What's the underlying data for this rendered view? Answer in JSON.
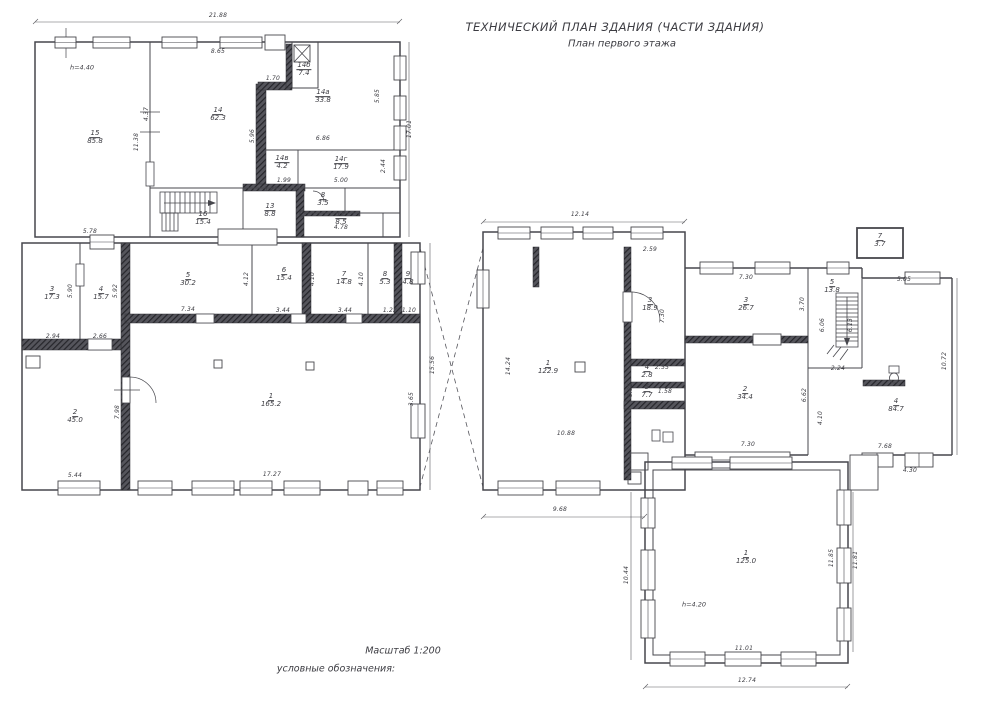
{
  "title": {
    "line1": "ТЕХНИЧЕСКИЙ ПЛАН ЗДАНИЯ (ЧАСТИ ЗДАНИЯ)",
    "line2": "План первого этажа"
  },
  "footer": {
    "scale_label": "Масштаб 1:200",
    "legend_label": "условные обозначения:"
  },
  "colors": {
    "ink": "#3c3c42",
    "wall": "#2f2f35",
    "paper": "#ffffff"
  },
  "plan": {
    "rooms": [
      {
        "num": "15",
        "area": "85.8",
        "x": 95,
        "y": 138
      },
      {
        "num": "14",
        "area": "62.3",
        "x": 218,
        "y": 115
      },
      {
        "num": "14б",
        "area": "7.4",
        "x": 304,
        "y": 70
      },
      {
        "num": "14а",
        "area": "33.8",
        "x": 323,
        "y": 97
      },
      {
        "num": "14в",
        "area": "4.2",
        "x": 282,
        "y": 163
      },
      {
        "num": "14г",
        "area": "17.9",
        "x": 341,
        "y": 164
      },
      {
        "num": "16",
        "area": "15.4",
        "x": 203,
        "y": 219
      },
      {
        "num": "13",
        "area": "8.8",
        "x": 270,
        "y": 211
      },
      {
        "num": "8",
        "area": "3.5",
        "x": 323,
        "y": 200
      },
      {
        "num": "12",
        "area": "8.5",
        "x": 341,
        "y": 219
      },
      {
        "num": "3",
        "area": "17.3",
        "x": 52,
        "y": 294
      },
      {
        "num": "4",
        "area": "15.7",
        "x": 101,
        "y": 294
      },
      {
        "num": "5",
        "area": "30.2",
        "x": 188,
        "y": 280
      },
      {
        "num": "6",
        "area": "15.4",
        "x": 284,
        "y": 275
      },
      {
        "num": "7",
        "area": "14.8",
        "x": 344,
        "y": 279
      },
      {
        "num": "8",
        "area": "5.3",
        "x": 385,
        "y": 279
      },
      {
        "num": "9",
        "area": "4.8",
        "x": 408,
        "y": 279
      },
      {
        "num": "2",
        "area": "45.0",
        "x": 75,
        "y": 417
      },
      {
        "num": "1",
        "area": "165.2",
        "x": 271,
        "y": 401
      },
      {
        "num": "1",
        "area": "122.9",
        "x": 548,
        "y": 368
      },
      {
        "num": "3",
        "area": "18.9",
        "x": 650,
        "y": 305
      },
      {
        "num": "4",
        "area": "2.8",
        "x": 647,
        "y": 372
      },
      {
        "num": "5",
        "area": "7.7",
        "x": 647,
        "y": 392
      },
      {
        "num": "3",
        "area": "26.7",
        "x": 746,
        "y": 305
      },
      {
        "num": "2",
        "area": "34.4",
        "x": 745,
        "y": 394
      },
      {
        "num": "5",
        "area": "13.8",
        "x": 832,
        "y": 287
      },
      {
        "num": "7",
        "area": "3.7",
        "x": 880,
        "y": 241
      },
      {
        "num": "4",
        "area": "84.7",
        "x": 896,
        "y": 406
      },
      {
        "num": "1",
        "area": "125.0",
        "x": 746,
        "y": 558
      }
    ],
    "dims": [
      {
        "t": "21.88",
        "x": 218,
        "y": 16
      },
      {
        "t": "8.65",
        "x": 218,
        "y": 52
      },
      {
        "t": "1.70",
        "x": 273,
        "y": 79
      },
      {
        "t": "5.96",
        "x": 253,
        "y": 136,
        "r": 1
      },
      {
        "t": "4.37",
        "x": 147,
        "y": 114,
        "r": 1
      },
      {
        "t": "11.38",
        "x": 137,
        "y": 142,
        "r": 1
      },
      {
        "t": "5.85",
        "x": 378,
        "y": 96,
        "r": 1
      },
      {
        "t": "17.01",
        "x": 410,
        "y": 129,
        "r": 1
      },
      {
        "t": "2.44",
        "x": 384,
        "y": 166,
        "r": 1
      },
      {
        "t": "6.86",
        "x": 323,
        "y": 139
      },
      {
        "t": "5.00",
        "x": 341,
        "y": 181
      },
      {
        "t": "1.99",
        "x": 284,
        "y": 181
      },
      {
        "t": "3.21",
        "x": 271,
        "y": 190
      },
      {
        "t": "4.78",
        "x": 341,
        "y": 228
      },
      {
        "t": "5.78",
        "x": 90,
        "y": 232
      },
      {
        "t": "2.94",
        "x": 53,
        "y": 337
      },
      {
        "t": "2.66",
        "x": 100,
        "y": 337
      },
      {
        "t": "7.34",
        "x": 188,
        "y": 310
      },
      {
        "t": "5.90",
        "x": 71,
        "y": 291,
        "r": 1
      },
      {
        "t": "5.92",
        "x": 116,
        "y": 291,
        "r": 1
      },
      {
        "t": "4.12",
        "x": 247,
        "y": 279,
        "r": 1
      },
      {
        "t": "4.10",
        "x": 313,
        "y": 279,
        "r": 1
      },
      {
        "t": "4.10",
        "x": 362,
        "y": 279,
        "r": 1
      },
      {
        "t": "3.44",
        "x": 283,
        "y": 311
      },
      {
        "t": "3.44",
        "x": 345,
        "y": 311
      },
      {
        "t": "1.22",
        "x": 390,
        "y": 311
      },
      {
        "t": "1.10",
        "x": 409,
        "y": 311
      },
      {
        "t": "7.98",
        "x": 118,
        "y": 412,
        "r": 1
      },
      {
        "t": "5.44",
        "x": 75,
        "y": 476
      },
      {
        "t": "17.27",
        "x": 272,
        "y": 475
      },
      {
        "t": "15.56",
        "x": 433,
        "y": 365,
        "r": 1
      },
      {
        "t": "3.65",
        "x": 412,
        "y": 399,
        "r": 1
      },
      {
        "t": "12.14",
        "x": 580,
        "y": 215
      },
      {
        "t": "2.59",
        "x": 650,
        "y": 250
      },
      {
        "t": "7.30",
        "x": 663,
        "y": 316,
        "r": 1
      },
      {
        "t": "14.24",
        "x": 509,
        "y": 366,
        "r": 1
      },
      {
        "t": "10.88",
        "x": 566,
        "y": 434
      },
      {
        "t": "9.68",
        "x": 560,
        "y": 510
      },
      {
        "t": "2.55",
        "x": 662,
        "y": 368
      },
      {
        "t": "1.58",
        "x": 665,
        "y": 392
      },
      {
        "t": "0.85",
        "x": 631,
        "y": 390,
        "r": 1
      },
      {
        "t": "7.30",
        "x": 746,
        "y": 278
      },
      {
        "t": "3.70",
        "x": 803,
        "y": 304,
        "r": 1
      },
      {
        "t": "7.30",
        "x": 748,
        "y": 445
      },
      {
        "t": "6.62",
        "x": 805,
        "y": 395,
        "r": 1
      },
      {
        "t": "6.06",
        "x": 823,
        "y": 325,
        "r": 1
      },
      {
        "t": "6.13",
        "x": 851,
        "y": 325,
        "r": 1
      },
      {
        "t": "2.24",
        "x": 838,
        "y": 369
      },
      {
        "t": "4.10",
        "x": 821,
        "y": 418,
        "r": 1
      },
      {
        "t": "5.05",
        "x": 904,
        "y": 280
      },
      {
        "t": "10.72",
        "x": 945,
        "y": 361,
        "r": 1
      },
      {
        "t": "7.68",
        "x": 885,
        "y": 447
      },
      {
        "t": "4.30",
        "x": 910,
        "y": 471
      },
      {
        "t": "11.01",
        "x": 744,
        "y": 649
      },
      {
        "t": "12.74",
        "x": 747,
        "y": 681
      },
      {
        "t": "11.85",
        "x": 832,
        "y": 558,
        "r": 1
      },
      {
        "t": "11.81",
        "x": 856,
        "y": 560,
        "r": 1
      },
      {
        "t": "10.44",
        "x": 627,
        "y": 575,
        "r": 1
      }
    ],
    "notes": [
      {
        "t": "h=4.40",
        "x": 82,
        "y": 68
      },
      {
        "t": "h=4.20",
        "x": 694,
        "y": 605
      }
    ]
  }
}
